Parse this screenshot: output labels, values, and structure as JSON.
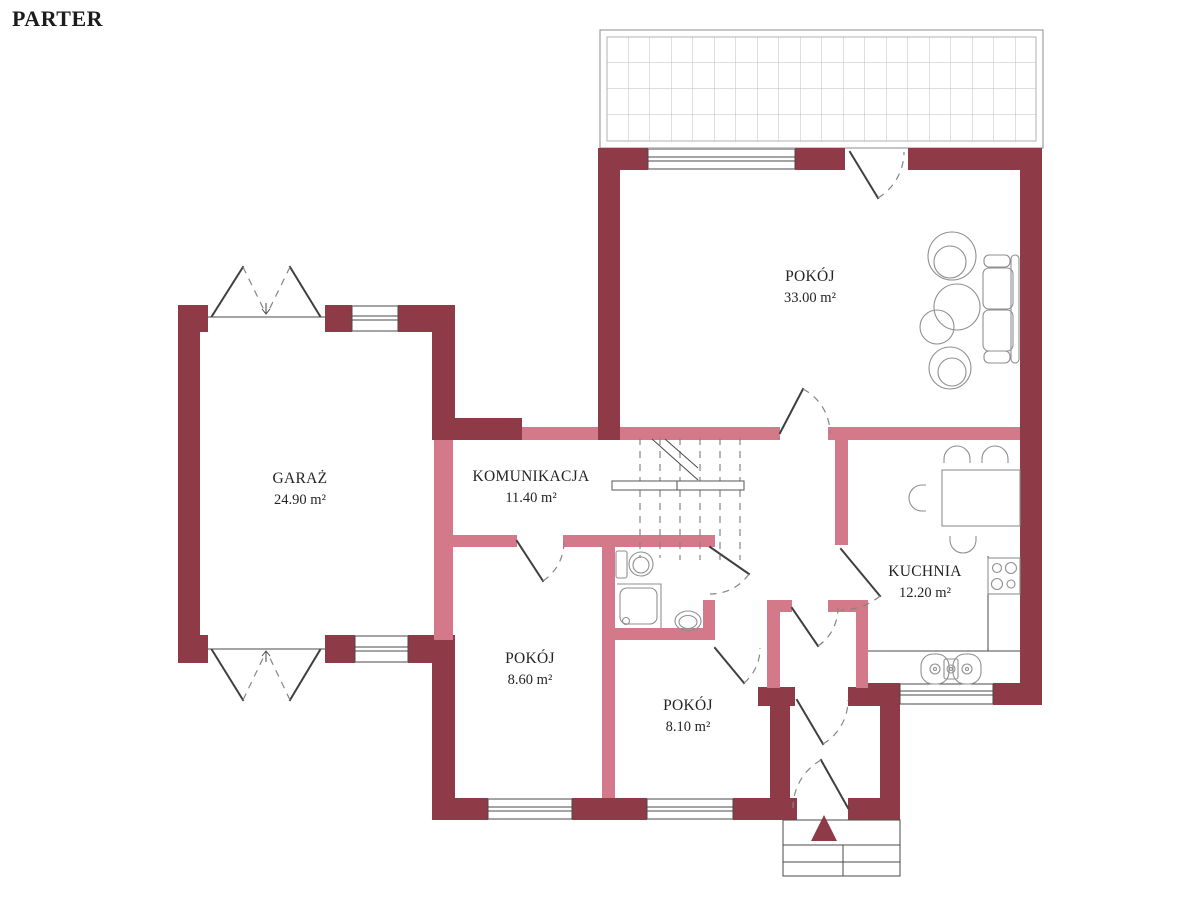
{
  "title": "PARTER",
  "floor_plan": {
    "rooms": [
      {
        "id": "pokoj-main",
        "name": "POKÓJ",
        "area": "33.00 m²"
      },
      {
        "id": "garaz",
        "name": "GARAŻ",
        "area": "24.90 m²"
      },
      {
        "id": "komunikacja",
        "name": "KOMUNIKACJA",
        "area": "11.40 m²"
      },
      {
        "id": "kuchnia",
        "name": "KUCHNIA",
        "area": "12.20 m²"
      },
      {
        "id": "pokoj-2",
        "name": "POKÓJ",
        "area": "8.60 m²"
      },
      {
        "id": "pokoj-3",
        "name": "POKÓJ",
        "area": "8.10 m²"
      }
    ]
  },
  "colors": {
    "wall_exterior": "#8e3b47",
    "wall_interior": "#d4798a",
    "entry_arrow": "#8e3b47",
    "line": "#3f3f3f",
    "furniture_line": "#8f8f8f",
    "text": "#242424"
  }
}
